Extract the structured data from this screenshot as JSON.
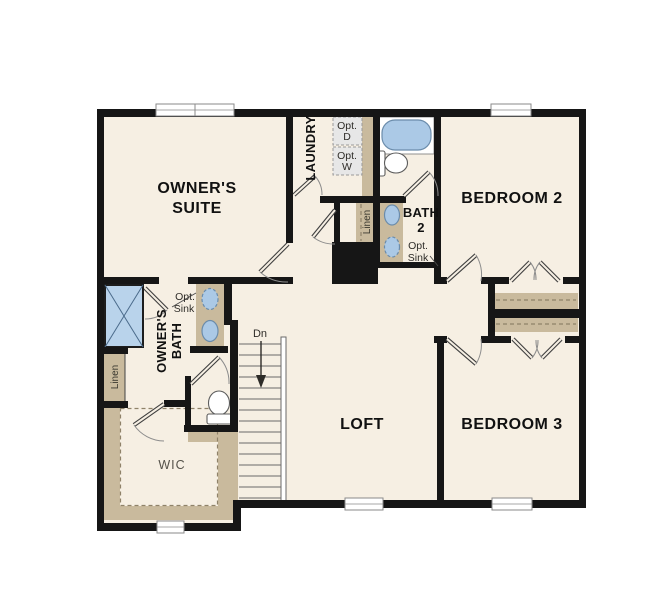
{
  "floor_plan": {
    "rooms": {
      "owners_suite": {
        "line1": "OWNER'S",
        "line2": "SUITE"
      },
      "laundry": {
        "label": "LAUNDRY"
      },
      "bedroom2": {
        "label": "BEDROOM 2"
      },
      "bath2": {
        "line1": "BATH",
        "line2": "2"
      },
      "owners_bath": {
        "line1": "OWNER'S",
        "line2": "BATH"
      },
      "loft": {
        "label": "LOFT"
      },
      "bedroom3": {
        "label": "BEDROOM 3"
      },
      "wic": {
        "label": "WIC"
      }
    },
    "annotations": {
      "opt_dryer": {
        "line1": "Opt.",
        "line2": "D"
      },
      "opt_washer": {
        "line1": "Opt.",
        "line2": "W"
      },
      "opt_sink_bath2": {
        "line1": "Opt.",
        "line2": "Sink"
      },
      "opt_sink_owners": {
        "line1": "Opt.",
        "line2": "Sink"
      },
      "linen_hall": {
        "label": "Linen"
      },
      "linen_owners": {
        "label": "Linen"
      },
      "stairs_down": {
        "label": "Dn"
      }
    },
    "colors": {
      "background": "#ffffff",
      "floor": "#f6efe3",
      "wall": "#161616",
      "casework": "#c9ba9d",
      "casework_line": "#8f8269",
      "fixture_blue": "#abc9e6",
      "fixture_blue_border": "#6b8cab",
      "appliance": "#e7e7e7",
      "window_frame": "#8a8a8a",
      "door_line": "#3f3f3f",
      "stair_line": "#6a6a6a",
      "text": "#111111",
      "text_muted": "#55524a"
    }
  }
}
